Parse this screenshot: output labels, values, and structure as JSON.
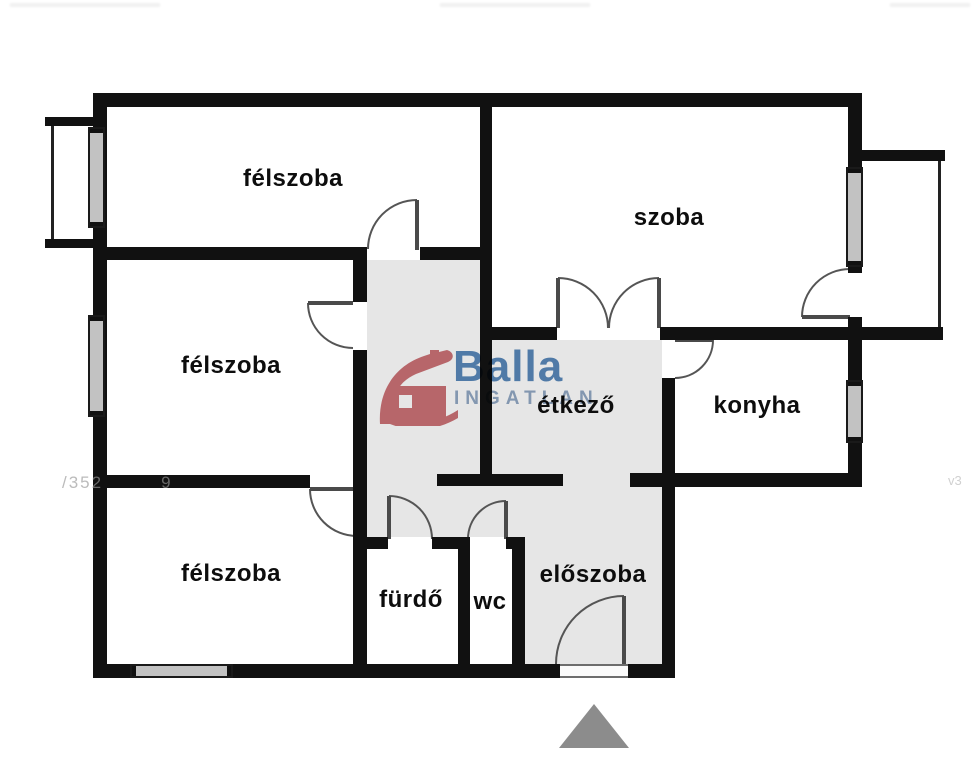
{
  "rooms": {
    "felszoba1": {
      "label": "félszoba"
    },
    "szoba": {
      "label": "szoba"
    },
    "felszoba2": {
      "label": "félszoba"
    },
    "etkezo": {
      "label": "étkező"
    },
    "konyha": {
      "label": "konyha"
    },
    "felszoba3": {
      "label": "félszoba"
    },
    "furdo": {
      "label": "fürdő"
    },
    "wc": {
      "label": "wc"
    },
    "eloszoba": {
      "label": "előszoba"
    }
  },
  "logo": {
    "brand": "Balla",
    "subtitle": "INGATLAN"
  },
  "watermarks": {
    "lot_fragment": "/352",
    "lot_fragment2": "9",
    "corner_fragment": "v3"
  },
  "colors": {
    "wall": "#111111",
    "hall_floor": "#e6e6e6",
    "logo_red": "#c8696e",
    "logo_blue": "#4f81b5",
    "logo_light_blue": "#8ba2c0",
    "north_arrow": "#8c8c8c",
    "window_fill": "#c2c2c2"
  }
}
